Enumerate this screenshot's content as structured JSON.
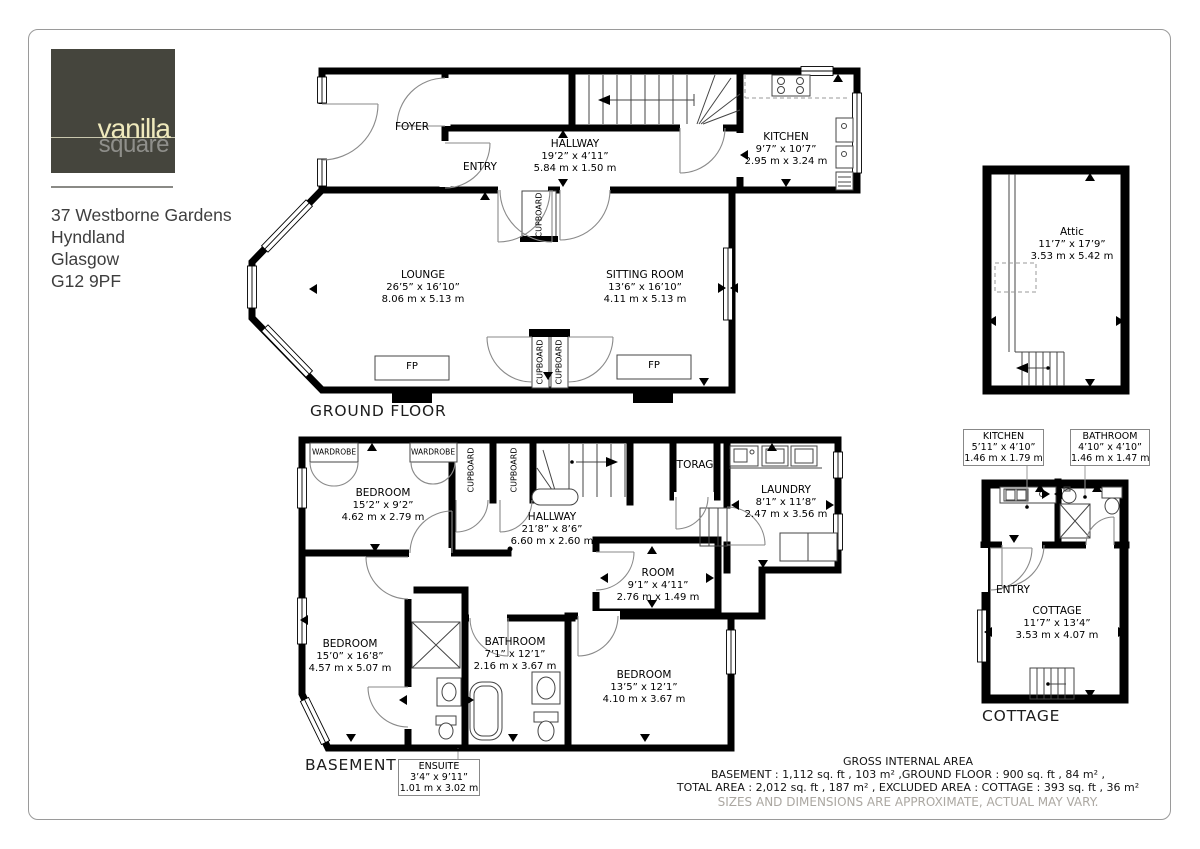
{
  "logo": {
    "brand_top": "vanilla",
    "brand_bottom": "square"
  },
  "address": {
    "line1": "37 Westborne Gardens",
    "line2": "Hyndland",
    "line3": "Glasgow",
    "line4": "G12 9PF"
  },
  "colors": {
    "wall": "#000000",
    "logo_bg": "#45453d",
    "logo_accent": "#efe9bc",
    "logo_gray": "#8f8f8b"
  },
  "floors": {
    "ground": {
      "title": "GROUND FLOOR",
      "rooms": {
        "foyer": {
          "name": "FOYER"
        },
        "entry": {
          "name": "ENTRY"
        },
        "hallway": {
          "name": "HALLWAY",
          "imperial": "19’2” x 4’11”",
          "metric": "5.84 m x 1.50 m"
        },
        "kitchen": {
          "name": "KITCHEN",
          "imperial": "9’7” x 10’7”",
          "metric": "2.95 m x 3.24 m"
        },
        "lounge": {
          "name": "LOUNGE",
          "imperial": "26’5” x 16’10”",
          "metric": "8.06 m x 5.13 m"
        },
        "sitting_room": {
          "name": "SITTING ROOM",
          "imperial": "13’6” x 16’10”",
          "metric": "4.11 m x 5.13 m"
        },
        "cupboard": {
          "name": "CUPBOARD"
        },
        "fireplace": {
          "abbr": "FP"
        }
      }
    },
    "attic": {
      "rooms": {
        "attic": {
          "name": "Attic",
          "imperial": "11’7” x 17’9”",
          "metric": "3.53 m x 5.42 m"
        }
      }
    },
    "basement": {
      "title": "BASEMENT",
      "rooms": {
        "wardrobe": {
          "name": "WARDROBE"
        },
        "cupboard": {
          "name": "CUPBOARD"
        },
        "bedroom1": {
          "name": "BEDROOM",
          "imperial": "15’2” x 9’2”",
          "metric": "4.62 m x 2.79 m"
        },
        "hallway": {
          "name": "HALLWAY",
          "imperial": "21’8” x 8’6”",
          "metric": "6.60 m x 2.60 m"
        },
        "storage": {
          "name": "STORAGE"
        },
        "laundry": {
          "name": "LAUNDRY",
          "imperial": "8’1” x 11’8”",
          "metric": "2.47 m x 3.56 m"
        },
        "room": {
          "name": "ROOM",
          "imperial": "9’1” x 4’11”",
          "metric": "2.76 m x 1.49 m"
        },
        "bedroom2": {
          "name": "BEDROOM",
          "imperial": "15’0” x 16’8”",
          "metric": "4.57 m x 5.07 m"
        },
        "bathroom": {
          "name": "BATHROOM",
          "imperial": "7’1” x 12’1”",
          "metric": "2.16 m x 3.67 m"
        },
        "bedroom3": {
          "name": "BEDROOM",
          "imperial": "13’5” x 12’1”",
          "metric": "4.10 m x 3.67 m"
        },
        "ensuite": {
          "name": "ENSUITE",
          "imperial": "3’4” x 9’11”",
          "metric": "1.01 m x 3.02 m"
        }
      }
    },
    "cottage": {
      "title": "COTTAGE",
      "rooms": {
        "kitchen": {
          "name": "KITCHEN",
          "imperial": "5’11” x 4’10”",
          "metric": "1.46 m x 1.79 m"
        },
        "bathroom": {
          "name": "BATHROOM",
          "imperial": "4’10” x 4’10”",
          "metric": "1.46 m x 1.47 m"
        },
        "entry": {
          "name": "ENTRY"
        },
        "cottage": {
          "name": "COTTAGE",
          "imperial": "11’7” x 13’4”",
          "metric": "3.53 m x 4.07 m"
        }
      }
    }
  },
  "footer": {
    "title": "GROSS INTERNAL AREA",
    "line1": "BASEMENT : 1,112 sq. ft , 103 m² ,GROUND FLOOR : 900 sq. ft , 84 m² ,",
    "line2": "TOTAL AREA : 2,012 sq. ft , 187 m² , EXCLUDED AREA : COTTAGE : 393 sq. ft , 36 m²",
    "disclaimer": "SIZES AND DIMENSIONS ARE APPROXIMATE, ACTUAL MAY VARY."
  }
}
